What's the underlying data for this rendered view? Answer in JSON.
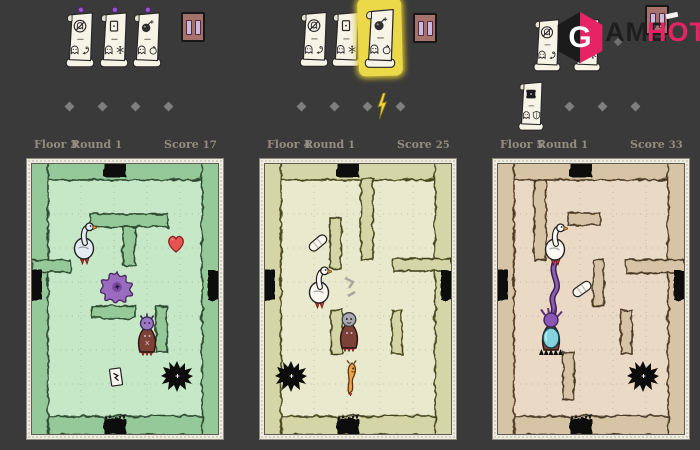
{
  "background": "#3a3a3a",
  "logo": {
    "monogram": "G",
    "text_dark": "AME",
    "text_pink": "HOT",
    "pink_color": "#e62465",
    "dark_color": "#1e1e1e"
  },
  "panels": [
    {
      "name": "floor-3-view",
      "stats": {
        "floor_label": "Floor",
        "floor_value": "3",
        "round_label": "Round",
        "round_value": "1",
        "score_label": "Score",
        "score_value": "17"
      },
      "cards": [
        {
          "top_icon": "no-ghost-icon",
          "bottom_icons": [
            "ghost-icon",
            "hook-icon"
          ],
          "pinned": true,
          "highlighted": false
        },
        {
          "top_icon": "spell-card-icon",
          "bottom_icons": [
            "ghost-icon",
            "snowflake-icon"
          ],
          "pinned": true,
          "highlighted": false
        },
        {
          "top_icon": "bomb-icon",
          "bottom_icons": [
            "ghost-icon",
            "apple-icon"
          ],
          "pinned": true,
          "highlighted": false
        }
      ],
      "progress": {
        "diamonds": 4,
        "lightning_bolt": false
      },
      "map": {
        "floor_color": "#c6e8c7",
        "wall_color": "#96c99a",
        "wall_outline": "#2c4a2e",
        "entities": [
          "goose",
          "heart-pickup",
          "splat-monster",
          "robed-monster",
          "card-pickup",
          "pit"
        ]
      }
    },
    {
      "name": "floor-4-view",
      "stats": {
        "floor_label": "Floor",
        "floor_value": "4",
        "round_label": "Round",
        "round_value": "1",
        "score_label": "Score",
        "score_value": "25"
      },
      "cards": [
        {
          "top_icon": "no-ghost-icon",
          "bottom_icons": [
            "ghost-icon",
            "hook-icon"
          ],
          "pinned": false,
          "highlighted": false
        },
        {
          "top_icon": "spell-card-icon",
          "bottom_icons": [
            "ghost-icon",
            "snowflake-icon"
          ],
          "pinned": false,
          "highlighted": false
        },
        {
          "top_icon": "bomb-icon",
          "bottom_icons": [
            "ghost-icon",
            "apple-icon"
          ],
          "pinned": false,
          "highlighted": true
        }
      ],
      "progress": {
        "diamonds": 4,
        "lightning_bolt": true
      },
      "map": {
        "floor_color": "#e9e9cd",
        "wall_color": "#d5d6a8",
        "wall_outline": "#45451f",
        "entities": [
          "bandage-pickup",
          "goose",
          "rubble",
          "robed-monster",
          "worm-monster",
          "pit"
        ]
      }
    },
    {
      "name": "floor-5-view",
      "stats": {
        "floor_label": "Floor",
        "floor_value": "5",
        "round_label": "Round",
        "round_value": "1",
        "score_label": "Score",
        "score_value": "33"
      },
      "cards": [
        {
          "top_icon": "no-ghost-icon",
          "bottom_icons": [
            "ghost-icon",
            "hook-icon"
          ],
          "pinned": false,
          "highlighted": false
        },
        {
          "top_icon": "spell-card-icon",
          "bottom_icons": [
            "ghost-icon",
            "snowflake-icon"
          ],
          "pinned": false,
          "highlighted": false
        },
        {
          "top_icon": "pit-icon",
          "bottom_icons": [
            "ghost-icon",
            "shield-icon"
          ],
          "pinned": false,
          "highlighted": false
        }
      ],
      "progress": {
        "diamonds": 4,
        "lightning_bolt": false
      },
      "map": {
        "floor_color": "#ead9c4",
        "wall_color": "#d7c3a5",
        "wall_outline": "#4a3824",
        "entities": [
          "goose",
          "tentacle",
          "bandage-pickup",
          "shielded-robed-monster",
          "pit"
        ]
      }
    }
  ]
}
